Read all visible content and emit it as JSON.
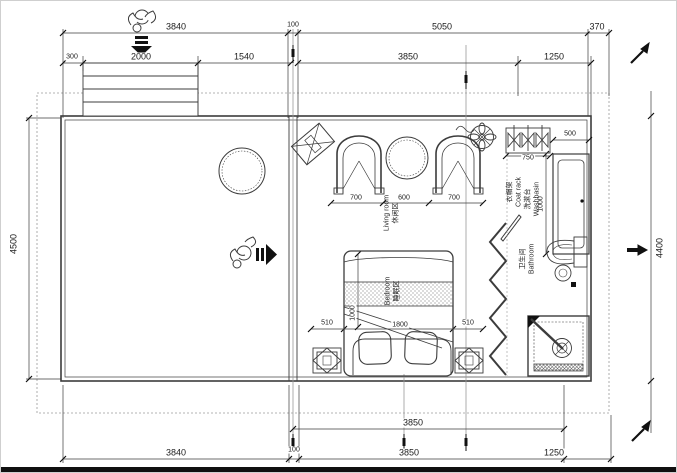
{
  "dims": {
    "top1": [
      "3840",
      "100",
      "5050",
      "370"
    ],
    "top2": [
      "300",
      "2000",
      "1540",
      "3850",
      "1250"
    ],
    "bottom1": [
      "3850"
    ],
    "bottom2": [
      "3840",
      "100",
      "3850",
      "1250"
    ],
    "left_height": "4500",
    "right_height": "4400",
    "living": [
      "700",
      "600",
      "700"
    ],
    "coat_rack_width": "750",
    "washbasin_width": "500",
    "washbasin_depth": "1000",
    "bed_row": [
      "510",
      "1800",
      "510"
    ],
    "bed_side": "1000"
  },
  "rooms": {
    "living": {
      "zh": "休闲区",
      "en": "Living room"
    },
    "bedroom": {
      "zh": "睡眠区",
      "en": "Bedroom"
    },
    "coat_rack": {
      "zh": "衣帽架",
      "en": "Coat rack"
    },
    "washbasin": {
      "zh": "洗漱台",
      "en": "Washbasin"
    },
    "bathroom": {
      "zh": "卫生间",
      "en": "Bathroom"
    }
  },
  "icons": {
    "person_top": "person-figure",
    "arrow_down": "entry-arrow-down",
    "person_side": "person-figure",
    "arrow_right": "entry-arrow-right",
    "fan": "ceiling-fan",
    "pen_markers": "pen-marker",
    "colors": {
      "line": "#3c3c3c",
      "light_line": "#9a9a9a",
      "hatch": "#b9b9b9",
      "solid": "#111111"
    }
  }
}
